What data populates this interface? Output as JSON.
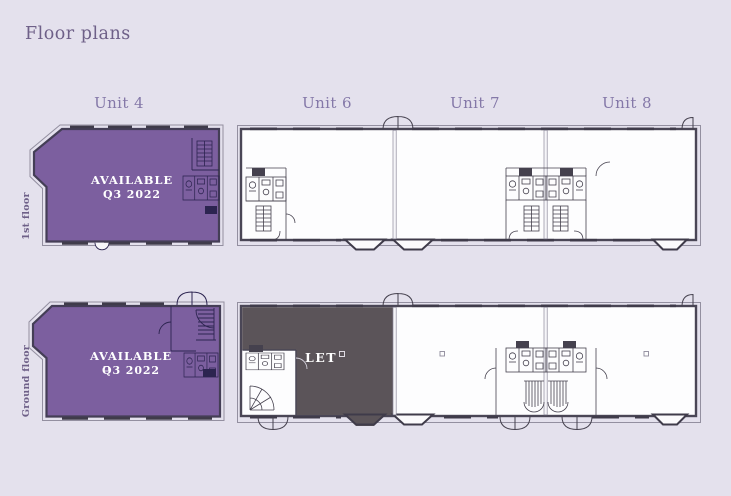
{
  "header": {
    "title": "Floor plans"
  },
  "unit_labels": [
    "Unit 4",
    "Unit 6",
    "Unit 7",
    "Unit 8"
  ],
  "floor_labels": {
    "first": "1st floor",
    "ground": "Ground floor"
  },
  "plans": {
    "unit4_first_floor": {
      "status_line1": "AVAILABLE",
      "status_line2": "Q3 2022"
    },
    "unit4_ground_floor": {
      "status_line1": "AVAILABLE",
      "status_line2": "Q3 2022"
    },
    "unit6_ground_floor": {
      "status": "LET"
    }
  },
  "colors": {
    "background": "#e4e1ed",
    "available_fill": "#7c5f9f",
    "let_fill": "#5b5459",
    "heading_text": "#6e6088",
    "unit_label_text": "#8478a8",
    "plan_line": "#4a4656",
    "status_text": "#ffffff"
  }
}
